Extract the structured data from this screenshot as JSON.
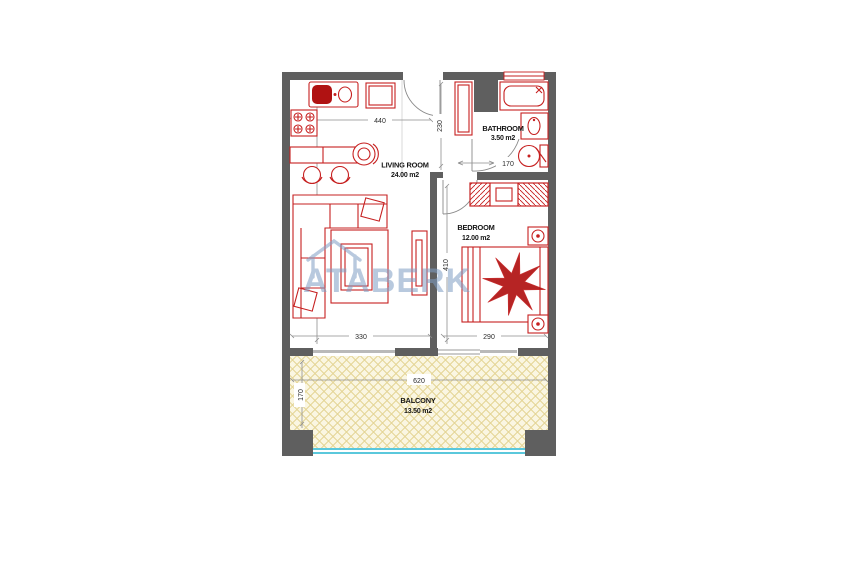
{
  "watermark": {
    "text": "ATABERK",
    "color": "#7f9dc4"
  },
  "plan": {
    "colors": {
      "wall": "#5f5f5f",
      "sill": "#b9b9b9",
      "furniture_red": "#c62020",
      "furniture_red_dark": "#b01212",
      "balcony_fill": "#faf6e2",
      "balcony_lattice": "#e4d494",
      "railing_cyan": "#5bc8dc",
      "door_line": "#8a8a8a",
      "dim_line": "#8f8f8f"
    },
    "rooms": [
      {
        "name": "LIVING ROOM",
        "area": "24.00 m2"
      },
      {
        "name": "BEDROOM",
        "area": "12.00 m2"
      },
      {
        "name": "BATHROOM",
        "area": "3.50 m2"
      },
      {
        "name": "BALCONY",
        "area": "13.50 m2"
      }
    ],
    "dimensions": {
      "kitchen_width": "440",
      "hall_depth": "230",
      "bath_door": "170",
      "living_depth": "650",
      "bedroom_depth": "410",
      "living_width": "330",
      "bedroom_width": "290",
      "balcony_width": "620",
      "balcony_depth": "170"
    }
  }
}
